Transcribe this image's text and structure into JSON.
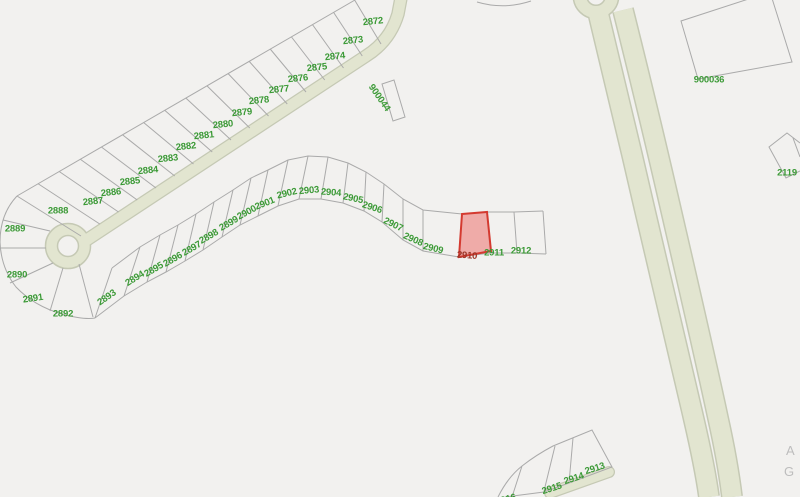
{
  "map": {
    "type": "parcel-gis-map",
    "colors": {
      "background": "#f2f1ef",
      "parcel_line": "#aaaaaa",
      "road_fill": "#e2e5d0",
      "road_casing": "#c5c9b4",
      "parcel_label": "#3c9a37",
      "selected_parcel_fill": "#ef9f9b",
      "selected_parcel_border": "#d43a30",
      "selected_parcel_label": "#9b3426",
      "edge_text": "#bdbdbd"
    },
    "selected_parcel": {
      "id": "2910"
    },
    "parcel_labels": [
      {
        "id": "2872",
        "x": 373,
        "y": 22,
        "rot": -6
      },
      {
        "id": "2873",
        "x": 353,
        "y": 41,
        "rot": -6
      },
      {
        "id": "2874",
        "x": 335,
        "y": 57,
        "rot": -6
      },
      {
        "id": "2875",
        "x": 317,
        "y": 68,
        "rot": -6
      },
      {
        "id": "2876",
        "x": 298,
        "y": 79,
        "rot": -6
      },
      {
        "id": "2877",
        "x": 279,
        "y": 90,
        "rot": -6
      },
      {
        "id": "2878",
        "x": 259,
        "y": 101,
        "rot": -6
      },
      {
        "id": "2879",
        "x": 242,
        "y": 113,
        "rot": -6
      },
      {
        "id": "2880",
        "x": 223,
        "y": 125,
        "rot": -6
      },
      {
        "id": "2881",
        "x": 204,
        "y": 136,
        "rot": -6
      },
      {
        "id": "2882",
        "x": 186,
        "y": 147,
        "rot": -6
      },
      {
        "id": "2883",
        "x": 168,
        "y": 159,
        "rot": -6
      },
      {
        "id": "2884",
        "x": 148,
        "y": 171,
        "rot": -6
      },
      {
        "id": "2885",
        "x": 130,
        "y": 182,
        "rot": -6
      },
      {
        "id": "2886",
        "x": 111,
        "y": 193,
        "rot": -6
      },
      {
        "id": "2887",
        "x": 93,
        "y": 202,
        "rot": -6
      },
      {
        "id": "2888",
        "x": 58,
        "y": 211,
        "rot": 0
      },
      {
        "id": "2889",
        "x": 15,
        "y": 229,
        "rot": 0
      },
      {
        "id": "2890",
        "x": 17,
        "y": 275,
        "rot": 0
      },
      {
        "id": "2891",
        "x": 33,
        "y": 299,
        "rot": -8
      },
      {
        "id": "2892",
        "x": 63,
        "y": 314,
        "rot": 0
      },
      {
        "id": "2893",
        "x": 107,
        "y": 298,
        "rot": -35
      },
      {
        "id": "2894",
        "x": 135,
        "y": 279,
        "rot": -32
      },
      {
        "id": "2895",
        "x": 154,
        "y": 270,
        "rot": -30
      },
      {
        "id": "2896",
        "x": 173,
        "y": 260,
        "rot": -30
      },
      {
        "id": "2897",
        "x": 192,
        "y": 249,
        "rot": -30
      },
      {
        "id": "2898",
        "x": 209,
        "y": 237,
        "rot": -30
      },
      {
        "id": "2899",
        "x": 229,
        "y": 224,
        "rot": -30
      },
      {
        "id": "2900",
        "x": 247,
        "y": 213,
        "rot": -28
      },
      {
        "id": "2901",
        "x": 265,
        "y": 204,
        "rot": -22
      },
      {
        "id": "2902",
        "x": 287,
        "y": 194,
        "rot": -14
      },
      {
        "id": "2903",
        "x": 309,
        "y": 191,
        "rot": -5
      },
      {
        "id": "2904",
        "x": 331,
        "y": 193,
        "rot": 4
      },
      {
        "id": "2905",
        "x": 353,
        "y": 199,
        "rot": 12
      },
      {
        "id": "2906",
        "x": 372,
        "y": 208,
        "rot": 18
      },
      {
        "id": "2907",
        "x": 393,
        "y": 225,
        "rot": 26
      },
      {
        "id": "2908",
        "x": 413,
        "y": 240,
        "rot": 24
      },
      {
        "id": "2909",
        "x": 433,
        "y": 249,
        "rot": 14
      },
      {
        "id": "2910",
        "x": 467,
        "y": 256,
        "rot": 4,
        "selected": true
      },
      {
        "id": "2911",
        "x": 494,
        "y": 253,
        "rot": 0
      },
      {
        "id": "2912",
        "x": 521,
        "y": 251,
        "rot": 0
      },
      {
        "id": "2913",
        "x": 595,
        "y": 469,
        "rot": -18
      },
      {
        "id": "2914",
        "x": 574,
        "y": 479,
        "rot": -18
      },
      {
        "id": "2915",
        "x": 552,
        "y": 489,
        "rot": -18
      },
      {
        "id": "2916",
        "x": 506,
        "y": 500,
        "rot": -15
      },
      {
        "id": "900044",
        "x": 379,
        "y": 98,
        "rot": 55
      },
      {
        "id": "900036",
        "x": 709,
        "y": 80,
        "rot": 0
      },
      {
        "id": "2119",
        "x": 787,
        "y": 173,
        "rot": 0
      }
    ],
    "edge_labels": [
      {
        "text": "A",
        "x": 786,
        "y": 443
      },
      {
        "text": "G",
        "x": 784,
        "y": 464
      }
    ]
  }
}
